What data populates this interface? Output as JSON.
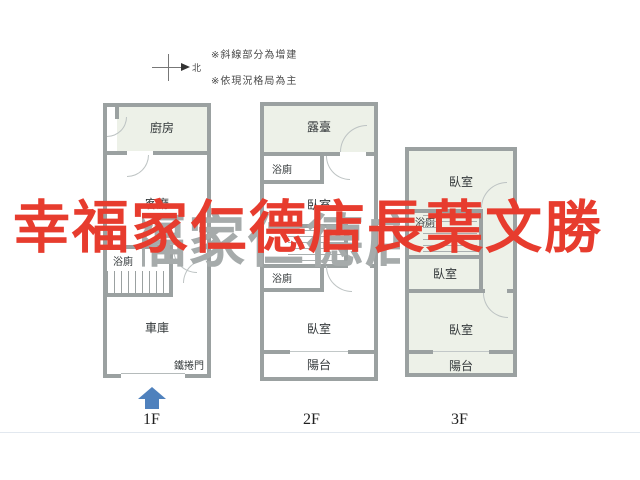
{
  "watermark": {
    "text": "幸福家仁德店長葉文勝"
  },
  "annotations": {
    "note_hatch": "※斜線部分為增建",
    "note_layout": "※依現況格局為主",
    "compass_north": "北"
  },
  "colors": {
    "wall_gray": "#9ba1a1",
    "room_fill_green": "#edf1e8",
    "watermark_red": "#e73c2e",
    "watermark_echo_gray": "#a6abab",
    "entry_arrow_blue": "#4f81bd"
  },
  "floors": [
    {
      "label": "1F",
      "rooms": [
        {
          "name": "kitchen",
          "label": "廚房"
        },
        {
          "name": "living-room",
          "label": "客廳"
        },
        {
          "name": "bathroom",
          "label": "浴廁"
        },
        {
          "name": "garage",
          "label": "車庫"
        }
      ],
      "annotations": [
        {
          "name": "roller-door",
          "label": "鐵捲門"
        }
      ]
    },
    {
      "label": "2F",
      "rooms": [
        {
          "name": "terrace",
          "label": "露臺"
        },
        {
          "name": "bathroom-upper",
          "label": "浴廁"
        },
        {
          "name": "bedroom-upper",
          "label": "臥室"
        },
        {
          "name": "bathroom-lower",
          "label": "浴廁"
        },
        {
          "name": "bedroom-lower",
          "label": "臥室"
        },
        {
          "name": "balcony",
          "label": "陽台"
        }
      ]
    },
    {
      "label": "3F",
      "rooms": [
        {
          "name": "bedroom-top",
          "label": "臥室"
        },
        {
          "name": "bathroom",
          "label": "浴廁"
        },
        {
          "name": "bedroom-middle",
          "label": "臥室"
        },
        {
          "name": "bedroom-lower",
          "label": "臥室"
        },
        {
          "name": "balcony",
          "label": "陽台"
        }
      ]
    }
  ]
}
